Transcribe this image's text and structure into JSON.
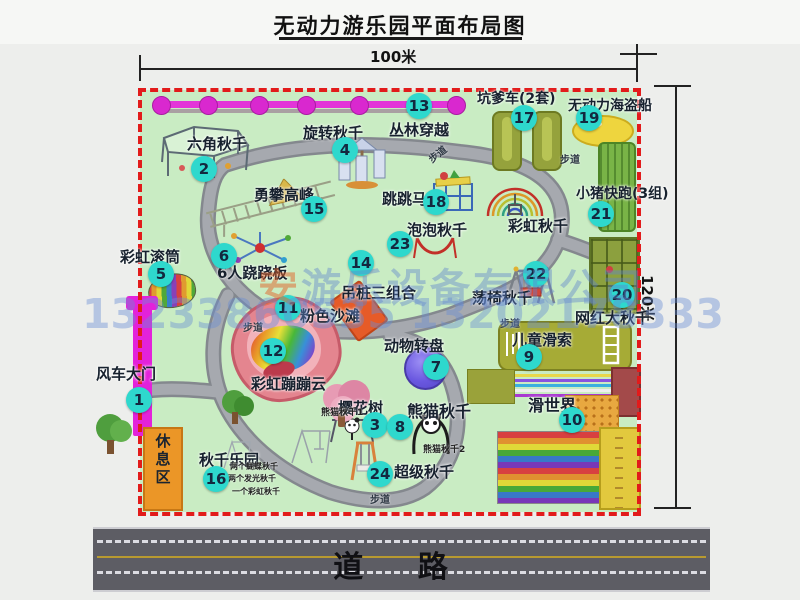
{
  "title": "无动力游乐园平面布局图",
  "dims": {
    "width": "100米",
    "height": "120米"
  },
  "road": {
    "label": "道  路"
  },
  "watermark": {
    "brand": "安",
    "company": "游乐设备有限公司",
    "phone": "13233860535 13202178333"
  },
  "rest_area": "休息区",
  "path_label": "步道",
  "swing_details": [
    "两个蝴蝶秋千",
    "两个发光秋千",
    "一个彩虹秋千"
  ],
  "extra_labels": {
    "rainbow_swing": "彩虹秋千",
    "panda1": "熊猫秋千1",
    "panda2": "熊猫秋千2"
  },
  "attractions": [
    {
      "num": "1",
      "name": "风车大门"
    },
    {
      "num": "2",
      "name": "六角秋千"
    },
    {
      "num": "3",
      "name": "樱花树"
    },
    {
      "num": "4",
      "name": "旋转秋千"
    },
    {
      "num": "5",
      "name": "彩虹滚筒"
    },
    {
      "num": "6",
      "name": "6人跷跷板"
    },
    {
      "num": "7",
      "name": "动物转盘"
    },
    {
      "num": "8",
      "name": "熊猫秋千"
    },
    {
      "num": "9",
      "name": "儿童滑索"
    },
    {
      "num": "10",
      "name": "滑世界"
    },
    {
      "num": "11",
      "name": "粉色沙滩"
    },
    {
      "num": "12",
      "name": "彩虹蹦蹦云"
    },
    {
      "num": "13",
      "name": "丛林穿越"
    },
    {
      "num": "14",
      "name": "吊桩三组合"
    },
    {
      "num": "15",
      "name": "勇攀高峰"
    },
    {
      "num": "16",
      "name": "秋千乐园"
    },
    {
      "num": "17",
      "name": "坑爹车(2套)"
    },
    {
      "num": "18",
      "name": "跳跳马"
    },
    {
      "num": "19",
      "name": "无动力海盗船"
    },
    {
      "num": "20",
      "name": "网红大秋千"
    },
    {
      "num": "21",
      "name": "小猪快跑(3组)"
    },
    {
      "num": "22",
      "name": "荡椅秋千"
    },
    {
      "num": "23",
      "name": "泡泡秋千"
    },
    {
      "num": "24",
      "name": "超级秋千"
    }
  ],
  "colors": {
    "map_green": "#c9ecc3",
    "border_red": "#e21b1b",
    "badge": "#2ed8cd",
    "magenta": "#e322da",
    "road_gray": "#5d5d64",
    "rest_orange": "#eb9627"
  }
}
